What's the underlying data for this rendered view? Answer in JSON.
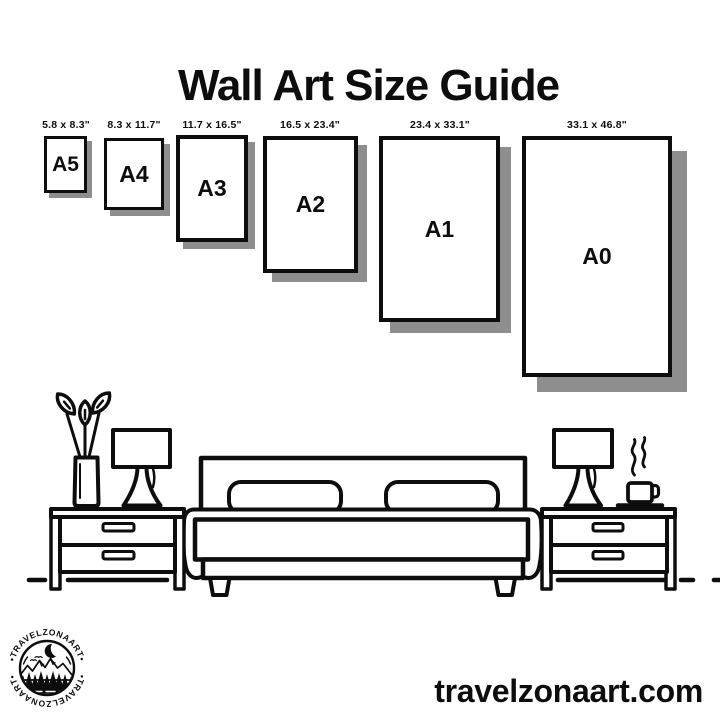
{
  "header": {
    "title": "Wall Art Size Guide"
  },
  "size_guide": {
    "frames": [
      {
        "label": "A5",
        "dimensions": "5.8 x 8.3\""
      },
      {
        "label": "A4",
        "dimensions": "8.3 x 11.7\""
      },
      {
        "label": "A3",
        "dimensions": "11.7 x 16.5\""
      },
      {
        "label": "A2",
        "dimensions": "16.5 x 23.4\""
      },
      {
        "label": "A1",
        "dimensions": "23.4 x 33.1\""
      },
      {
        "label": "A0",
        "dimensions": "33.1 x 46.8\""
      }
    ]
  },
  "illustration": {
    "icons": [
      "plant",
      "table-lamp",
      "nightstand",
      "double-bed",
      "coffee-cup",
      "steam",
      "floor-line"
    ]
  },
  "logo": {
    "brand": "TRAVELZONAART",
    "text_top": "•TRAVELZONAART•",
    "text_bottom": "•TRAVELZONAART•"
  },
  "footer": {
    "website": "travelzonaart.com"
  },
  "colors": {
    "background": "#ffffff",
    "ink": "#0d0d0d",
    "frame_shadow": "#8e8e8e"
  }
}
